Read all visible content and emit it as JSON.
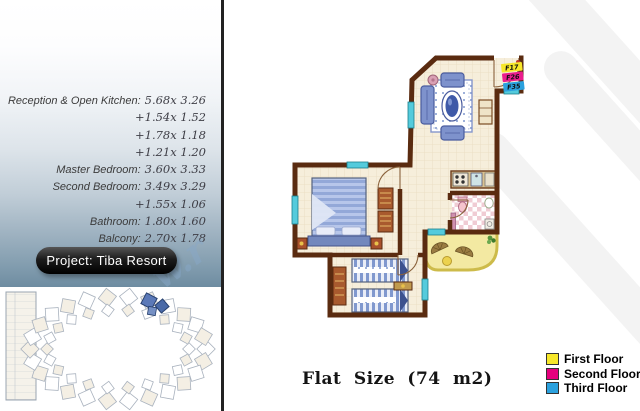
{
  "sidebar": {
    "dimensions": [
      {
        "label": "Reception & Open Kitchen:",
        "value": "5.68x 3.26"
      },
      {
        "label": "",
        "value": "+1.54x 1.52"
      },
      {
        "label": "",
        "value": "+1.78x 1.18"
      },
      {
        "label": "",
        "value": "+1.21x 1.20"
      },
      {
        "label": "Master Bedroom:",
        "value": "3.60x 3.33"
      },
      {
        "label": "Second Bedroom:",
        "value": "3.49x 3.29"
      },
      {
        "label": "",
        "value": "+1.55x 1.06"
      },
      {
        "label": "Bathroom:",
        "value": "1.80x 1.60"
      },
      {
        "label": "Balcony:",
        "value": "2.70x 1.78"
      }
    ],
    "project_badge": "Project: Tiba Resort"
  },
  "floorplan": {
    "unit_labels": [
      {
        "label": "F17",
        "color": "#f7e72a"
      },
      {
        "label": "F26",
        "color": "#ea1d8d"
      },
      {
        "label": "F35",
        "color": "#2ba1de"
      }
    ]
  },
  "footer": {
    "flat_size": "Flat Size (74 m2)"
  },
  "legend": {
    "items": [
      {
        "label": "First Floor",
        "color": "#f7e72a"
      },
      {
        "label": "Second Floor",
        "color": "#e5007d"
      },
      {
        "label": "Third Floor",
        "color": "#2ba1de"
      }
    ]
  },
  "watermark": {
    "fragment": "w.r"
  }
}
